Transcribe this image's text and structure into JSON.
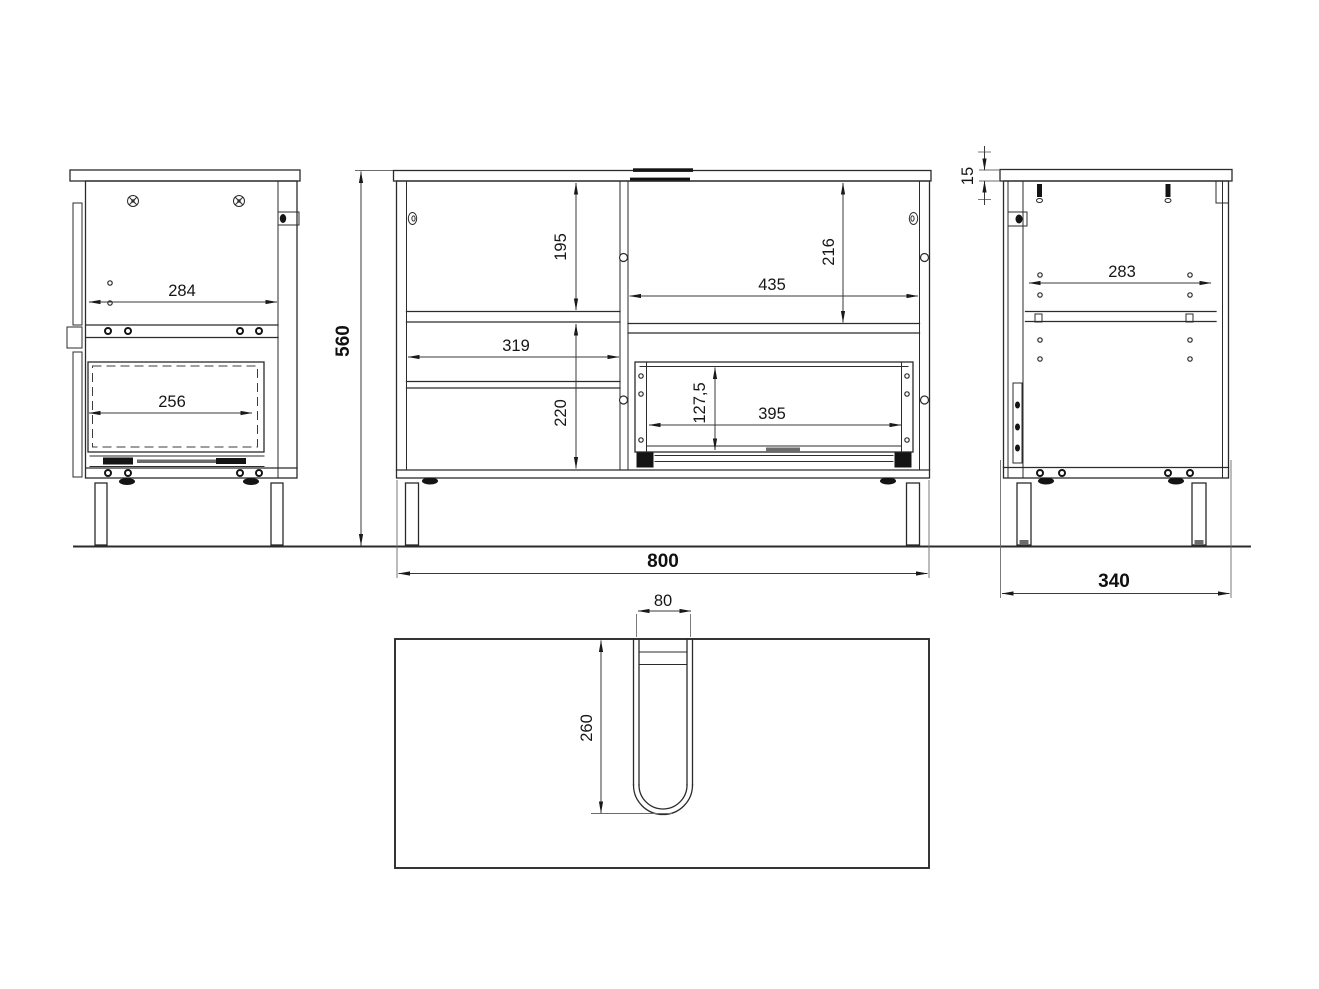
{
  "drawing": {
    "type": "furniture technical drawing",
    "colors": {
      "background": "#ffffff",
      "line": "#2b2b2b",
      "dimension_text": "#161616"
    }
  },
  "views": {
    "side_left": {
      "dim_depth": "284",
      "dim_drawer_depth": "256"
    },
    "front": {
      "dim_height": "560",
      "dim_top_left_section": "195",
      "dim_left_width": "319",
      "dim_bottom_left_section": "220",
      "dim_right_width": "435",
      "dim_right_top_section": "216",
      "dim_drawer_height": "127,5",
      "dim_drawer_width": "395",
      "dim_total_width": "800"
    },
    "side_right": {
      "dim_top_thickness": "15",
      "dim_inner_width": "283",
      "dim_total_depth": "340"
    },
    "bottom": {
      "dim_cutout_width": "80",
      "dim_cutout_depth": "260"
    }
  }
}
